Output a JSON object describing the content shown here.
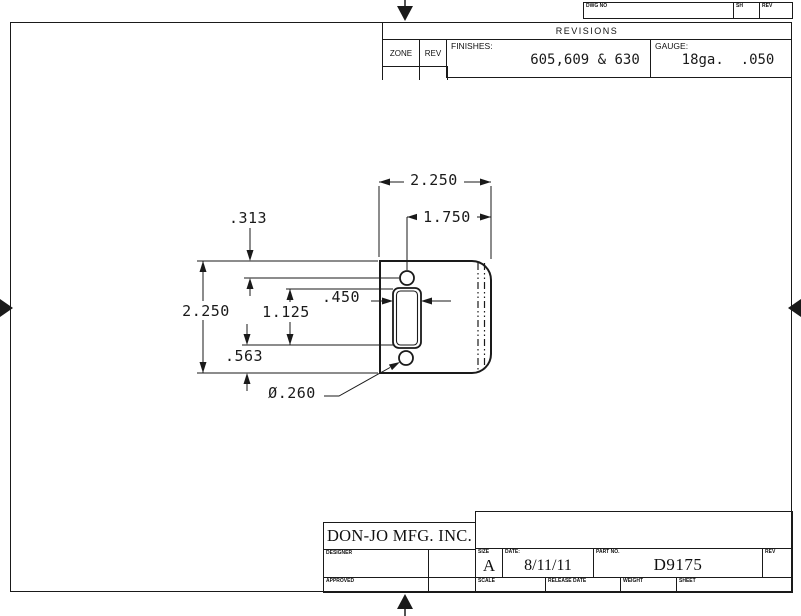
{
  "header_strip": {
    "dwg_no_label": "DWG NO",
    "sh_label": "SH",
    "rev_label": "REV"
  },
  "revisions_block": {
    "title": "REVISIONS",
    "zone_label": "ZONE",
    "rev_label": "REV",
    "finishes_label": "FINISHES:",
    "finishes_value": "605,609 & 630",
    "gauge_label": "GAUGE:",
    "gauge_value": "18ga.  .050"
  },
  "title_block": {
    "company": "DON-JO MFG. INC.",
    "designer_label": "DESIGNER",
    "approved_label": "APPROVED",
    "size_label": "SIZE",
    "size_value": "A",
    "date_label": "DATE:",
    "date_value": "8/11/11",
    "part_no_label": "PART NO.",
    "part_no_value": "D9175",
    "rev_label": "REV",
    "scale_label": "SCALE",
    "release_date_label": "RELEASE DATE",
    "weight_label": "WEIGHT",
    "sheet_label": "SHEET"
  },
  "drawing": {
    "dim_overall_width": "2.250",
    "dim_hole_to_right_edge": "1.750",
    "dim_hole_from_top": ".313",
    "dim_slot_width": ".450",
    "dim_slot_height": "1.125",
    "dim_overall_height": "2.250",
    "dim_slot_to_bottom": ".563",
    "dim_hole_diameter": "Ø.260"
  }
}
